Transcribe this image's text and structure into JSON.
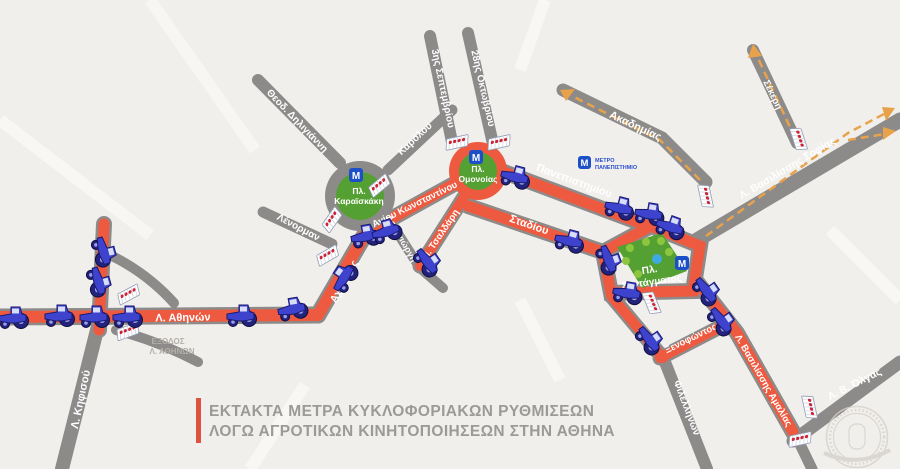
{
  "title": {
    "line1": "ΕΚΤΑΚΤΑ ΜΕΤΡΑ ΚΥΚΛΟΦΟΡΙΑΚΩΝ ΡΥΘΜΙΣΕΩΝ",
    "line2": "ΛΟΓΩ ΑΓΡΟΤΙΚΩΝ ΚΙΝΗΤΟΠΟΙΗΣΕΩΝ ΣΤΗΝ ΑΘΗΝΑ"
  },
  "colors": {
    "closed_road": "#ee5a40",
    "open_road": "#8d8b8a",
    "square_green": "#54a033",
    "metro_blue": "#1d50c8",
    "accent_bar": "#de5340",
    "route_arrow": "#e8a24b"
  },
  "streets": {
    "athinon": "Λ. Αθηνών",
    "kifisou": "Λ. Κηφισού",
    "achilleos": "Αχιλλέως",
    "lenorman": "Λένορμαν",
    "deligianni": "Θεοδ. Δηλιγιάννη",
    "karolou": "Καρόλου",
    "agiou_konstantinou": "Αγίου Κωνσταντίνου",
    "deligiorgi": "Δεληγιώργη",
    "tsaldari": "Π. Τσαλδάρη",
    "septemvriou": "3ης Σεπτεμβρίου",
    "oktovriou": "28ης Οκτωβρίου",
    "stadiou": "Σταδίου",
    "panepistimiou": "Πανεπιστημίου",
    "akadimias": "Ακαδημίας",
    "sekeri": "Σέκερη",
    "vas_sofias": "Λ. Βασιλίσσης Σοφίας",
    "xenofontos": "Ξενοφώντος",
    "filellinon": "Φιλελλήνων",
    "vas_amalias": "Λ. Βασιλίσσης Αμαλίας",
    "vas_olgas": "Λ. Β. Όλγας"
  },
  "squares": {
    "karaiskaki_l1": "Πλ.",
    "karaiskaki_l2": "Καραϊσκάκη",
    "omonoia_l1": "Πλ.",
    "omonoia_l2": "Ομονοίας",
    "syntagma_l1": "Πλ.",
    "syntagma_l2": "Συντάγματος"
  },
  "metro": {
    "m": "M",
    "legend_l1": "ΜΕΤΡΟ",
    "legend_l2": "ΠΑΝΕΠΙΣΤΗΜΙΟ"
  },
  "notes": {
    "exit_l1": "ΕΞΟΔΟΣ",
    "exit_l2": "Λ. ΑΘΗΝΩΝ"
  }
}
